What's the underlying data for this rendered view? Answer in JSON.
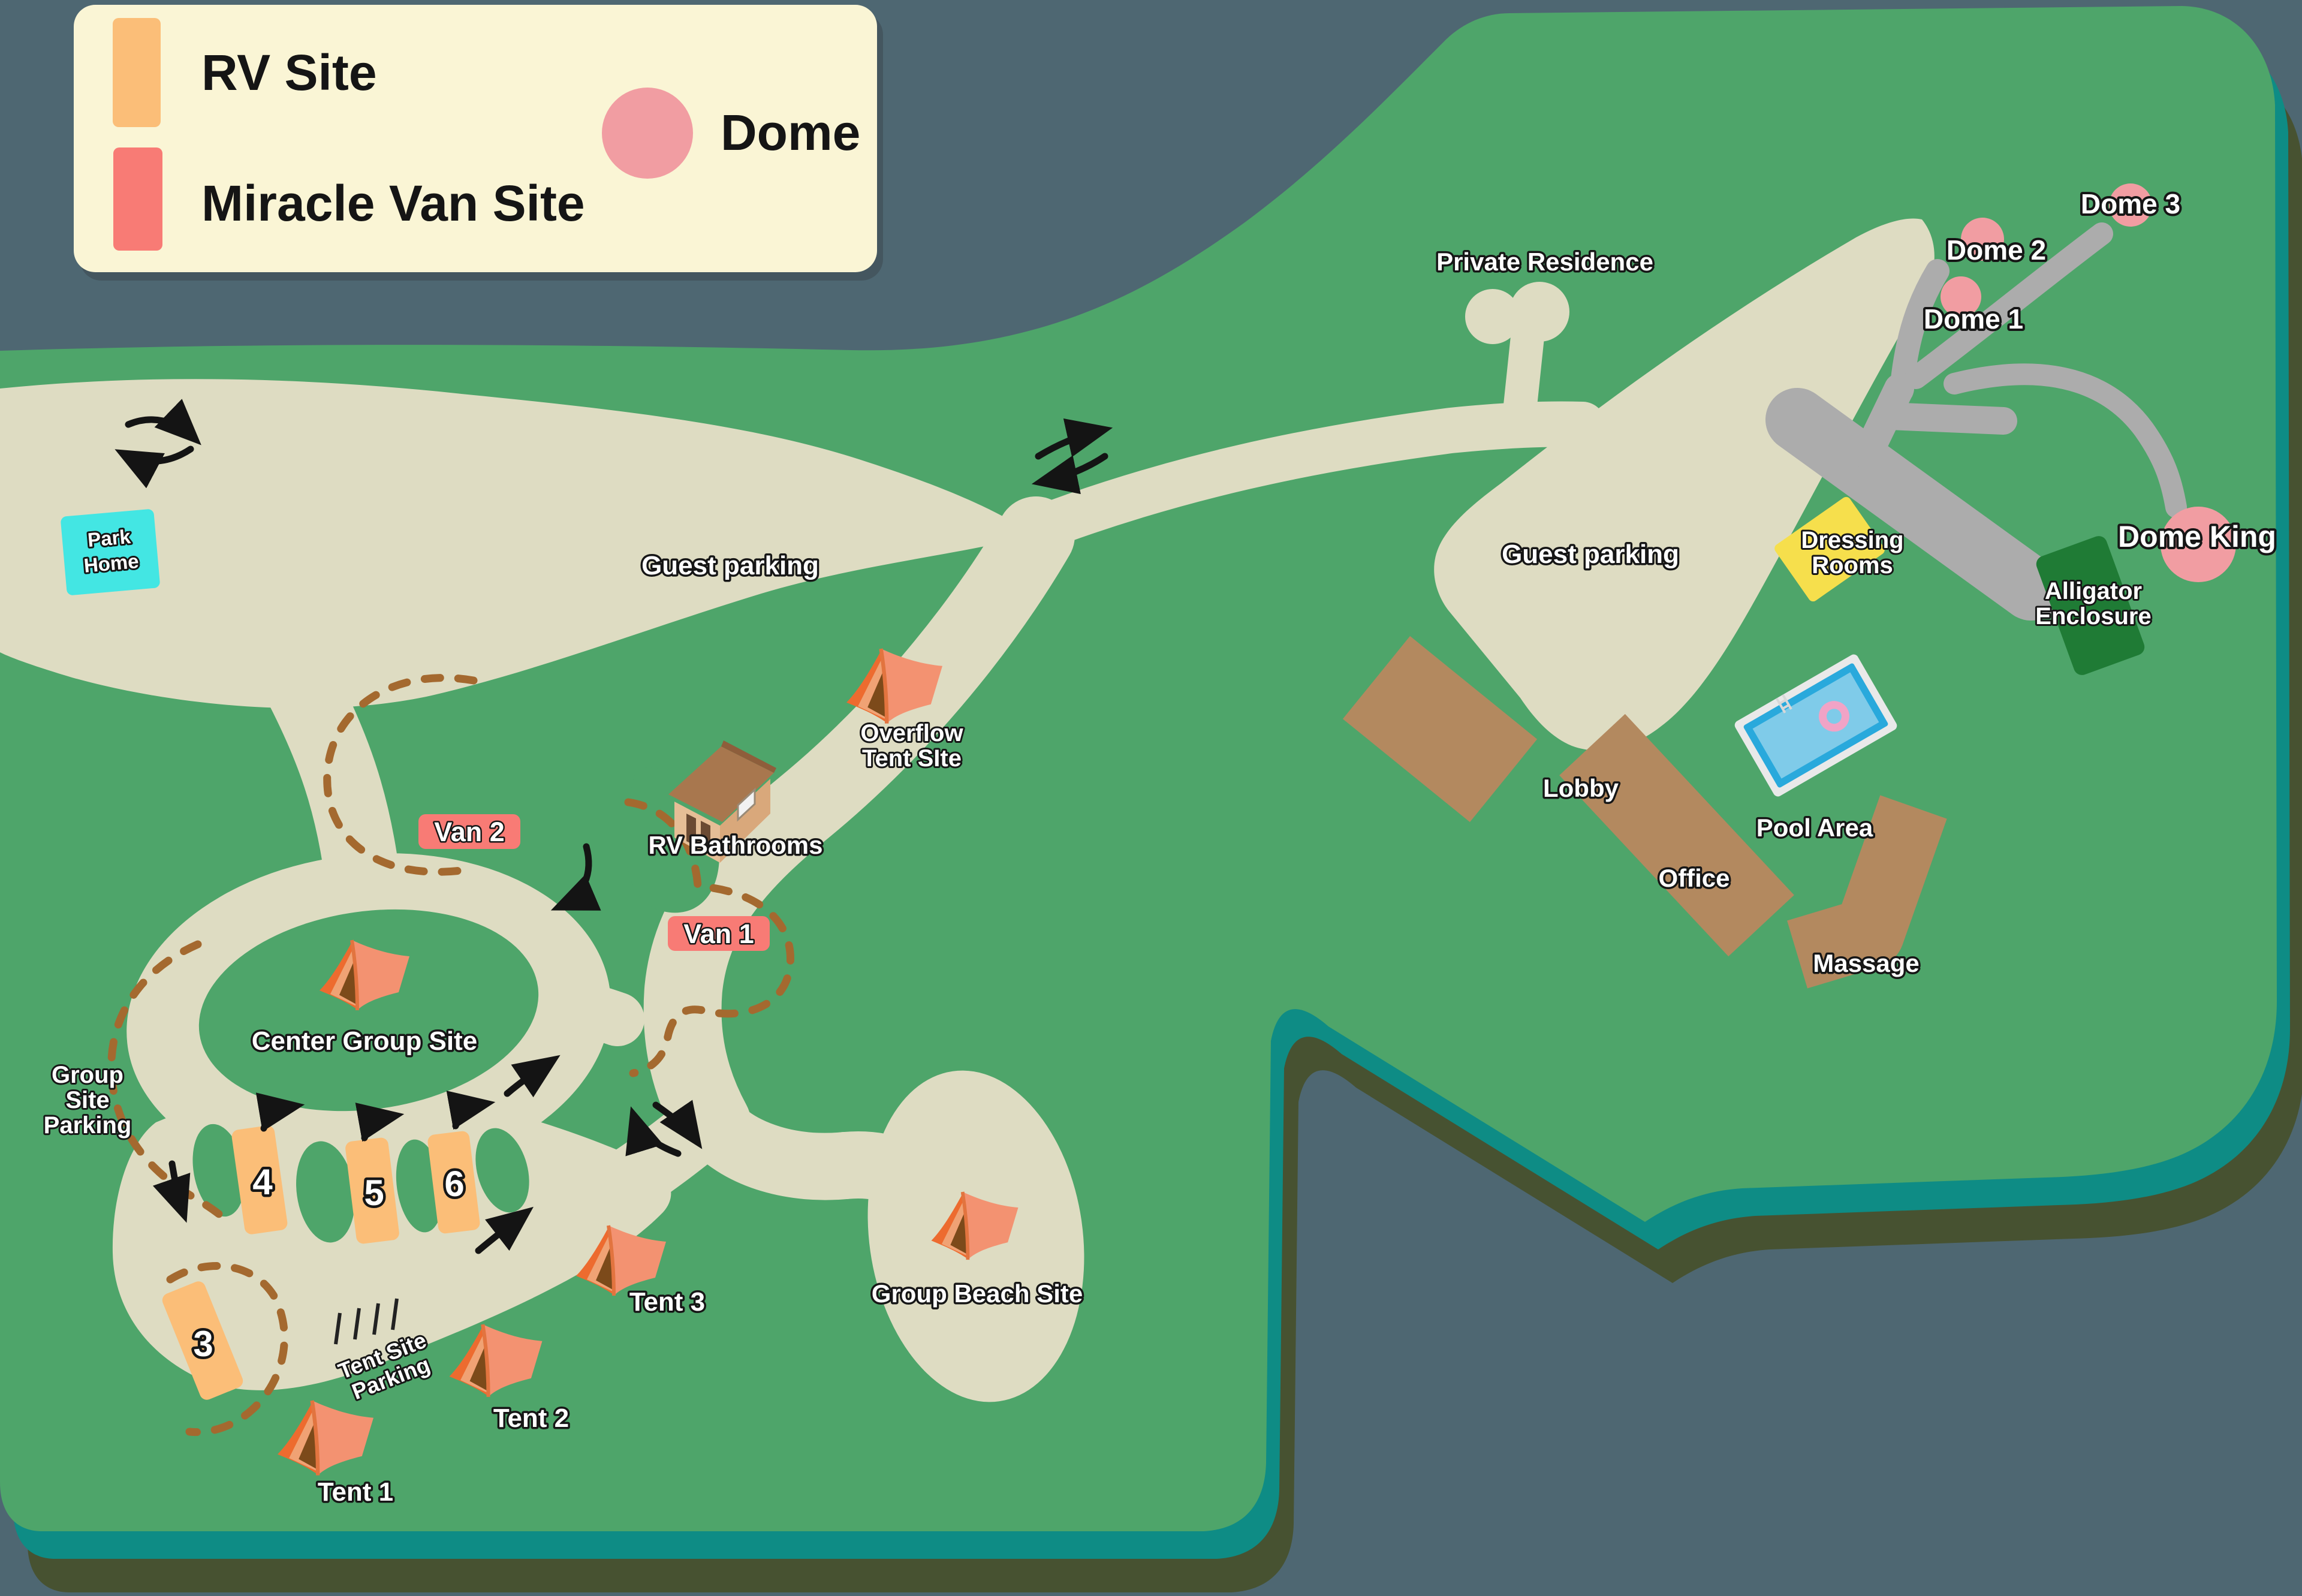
{
  "title": "Campground resort map",
  "palette": {
    "background": "#4E6772",
    "land": "#4EA56A",
    "shore_teal": "#0E8C85",
    "land_shadow": "#475231",
    "road_beige": "#DEDCC2",
    "driveway_gray": "#ACACAC",
    "building_brown": "#B3895F",
    "legend_bg": "#FAF5D5",
    "rv_site_orange": "#FBBE78",
    "van_site_red": "#F87B75",
    "dome_pink": "#F19DA2",
    "park_home_cyan": "#43E6E3",
    "dressing_rooms_yellow": "#F6DF4C",
    "alligator_green": "#1F7B35",
    "pool_blue": "#29A9DC",
    "pool_blue_light": "#7FCBE9",
    "boundary_dash_brown": "#A4692F",
    "tent_orange": "#F08C60",
    "arrow_black": "#141414"
  },
  "legend": {
    "rv_label": "RV Site",
    "van_label": "Miracle Van Site",
    "dome_label": "Dome"
  },
  "map": {
    "park_home": {
      "line1": "Park",
      "line2": "Home"
    },
    "guest_parking_west": "Guest parking",
    "guest_parking_east": "Guest parking",
    "private_residence": "Private Residence",
    "dressing_rooms": {
      "line1": "Dressing",
      "line2": "Rooms"
    },
    "domes": {
      "dome1": "Dome 1",
      "dome2": "Dome 2",
      "dome3": "Dome 3",
      "dome_king": "Dome King"
    },
    "alligator": {
      "line1": "Alligator",
      "line2": "Enclosure"
    },
    "buildings": {
      "lobby": "Lobby",
      "office": "Office",
      "massage": "Massage",
      "pool_area": "Pool Area"
    },
    "overflow": {
      "line1": "Overflow",
      "line2": "Tent SIte"
    },
    "rv_bathrooms": "RV Bathrooms",
    "van_sites": {
      "van1": "Van 1",
      "van2": "Van 2"
    },
    "center_group_site": "Center Group Site",
    "group_site_parking": {
      "line1": "Group",
      "line2": "Site",
      "line3": "Parking"
    },
    "rv_site_numbers": {
      "site3": "3",
      "site4": "4",
      "site5": "5",
      "site6": "6"
    },
    "tent_site_parking": {
      "line1": "Tent Site",
      "line2": "Parking"
    },
    "tents": {
      "tent1": "Tent 1",
      "tent2": "Tent 2",
      "tent3": "Tent 3"
    },
    "group_beach_site": "Group Beach Site"
  }
}
